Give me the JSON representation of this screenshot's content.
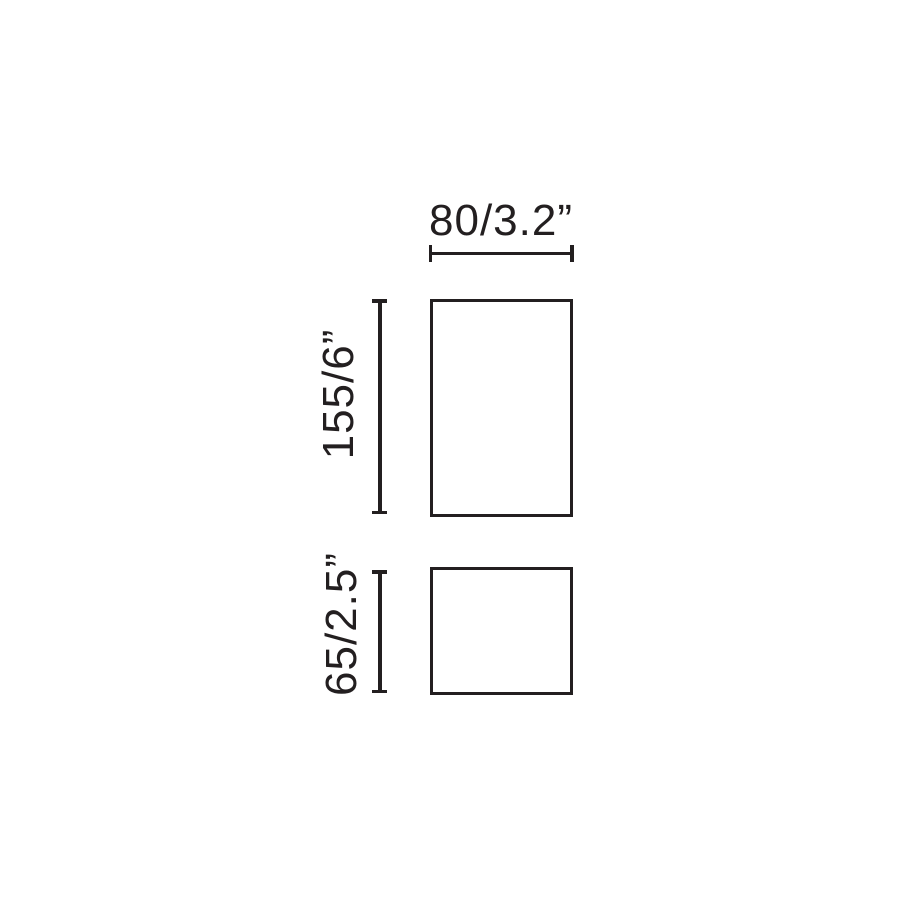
{
  "diagram": {
    "type": "technical-dimension-drawing",
    "dimensions": {
      "width": {
        "label": "80/3.2”",
        "millimeters": 80,
        "inches": 3.2
      },
      "height_top": {
        "label": "155/6”",
        "millimeters": 155,
        "inches": 6
      },
      "height_bottom": {
        "label": "65/2.5”",
        "millimeters": 65,
        "inches": 2.5
      }
    },
    "colors": {
      "stroke": "#231f20",
      "background": "#ffffff"
    }
  }
}
